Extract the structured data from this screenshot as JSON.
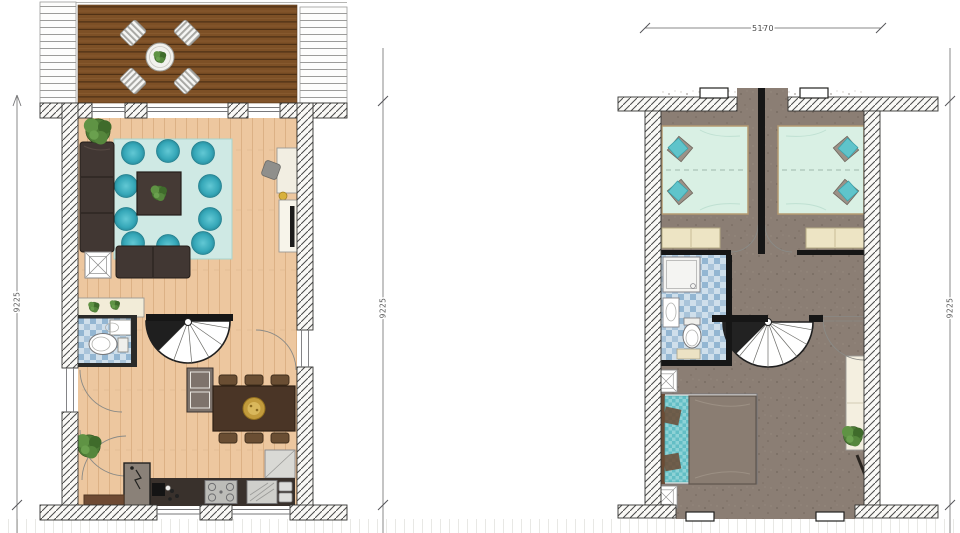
{
  "title": "floor-plan-drawing",
  "dimensions": {
    "left_vertical": "9225",
    "middle_vertical": "9225",
    "right_vertical": "9225",
    "top_horizontal": "5170"
  },
  "plans": [
    {
      "name": "ground-floor",
      "rooms": [
        "terrace",
        "living-room",
        "hallway",
        "bathroom",
        "dining-area",
        "kitchen",
        "entrance"
      ],
      "furniture": [
        "terrace-table",
        "terrace-chairs",
        "corner-sofa",
        "rug",
        "teal-poufs",
        "coffee-table",
        "side-table",
        "sideboard",
        "desk",
        "tv-cabinet",
        "toilet",
        "washbasin",
        "spiral-staircase",
        "wardrobe",
        "utility-closet",
        "dining-table",
        "dining-chairs",
        "kitchen-counter",
        "stove",
        "kitchen-sink",
        "worktop",
        "doormat",
        "plants"
      ]
    },
    {
      "name": "first-floor",
      "rooms": [
        "bedroom-left",
        "bedroom-right",
        "bathroom",
        "landing",
        "master-bedroom"
      ],
      "furniture": [
        "double-bed-left",
        "double-bed-right",
        "foot-bench-left",
        "foot-bench-right",
        "shower",
        "washbasin",
        "toilet",
        "spiral-staircase",
        "dresser",
        "master-bed",
        "nightstands",
        "wall-bench",
        "plant"
      ]
    }
  ],
  "palette": {
    "deck_wood": "#7d5026",
    "interior_floor": "#eec9a3",
    "rug_mint": "#cfe9e4",
    "pouf_teal": "#35a7b8",
    "sofa_dark": "#413733",
    "upper_floor_taupe": "#8b7e74",
    "bed_linen_mint": "#d9f0e4",
    "pillow_teal": "#5fc4cb",
    "bathroom_tile_blue": "#b3cde0",
    "bench_cream": "#ede4c4",
    "wall_hatch": "#4a4a4a",
    "dimension_text": "#5a5a5a"
  }
}
